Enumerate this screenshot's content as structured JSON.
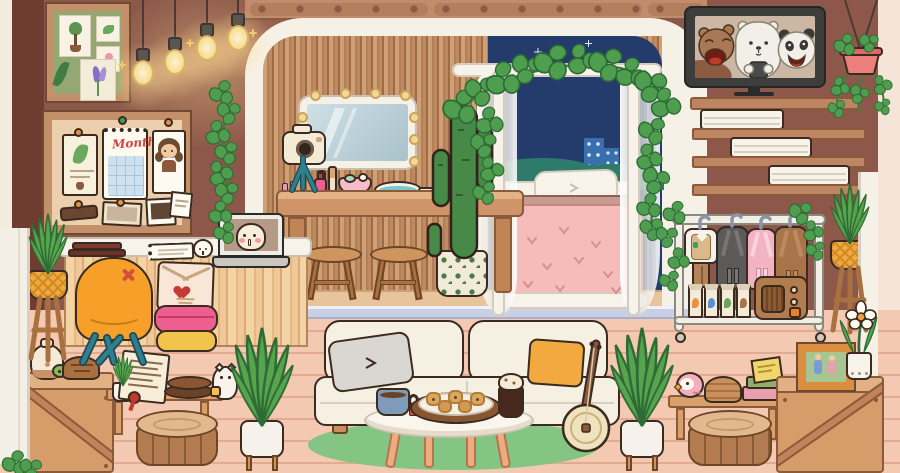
{
  "scene": {
    "name": "cozy-cartoon-room",
    "style": "toca-life-cartoon",
    "canvas": {
      "width": 900,
      "height": 473
    },
    "time_of_day_window": "night"
  },
  "texts": {
    "calendar_month": "Month"
  },
  "palette": {
    "wall": "#8d584a",
    "beam_wood": "#c18c6b",
    "arch_white": "#f6f1e7",
    "stripe_wallpaper": "#c1895f",
    "night_sky": "#233c6b",
    "floor": "#f4c9b2",
    "alcove_floor": "#e7c49c",
    "step": "#c9cfe4",
    "rug": "#84c584",
    "chair_orange": "#f6a029",
    "chair_legs_teal": "#2f7f8e",
    "box_pink": "#ee5f90",
    "box_yellow": "#f3c44d",
    "blanket_pink": "#f6bcba",
    "leaf_green": "#4f9e50",
    "crate_wood": "#d69c6a",
    "tv_frame": "#3d3d3b",
    "radio_brown": "#b27c4e",
    "hanging_pot_pink": "#ea7f7c",
    "basket_pot_yellow": "#eeaa3f"
  },
  "counts": {
    "hanging_bulbs": 4,
    "mirror_bulbs": 9,
    "stools": 2,
    "cookies": 5,
    "drink_cartons": 4,
    "hanging_outfits": 4,
    "white_book_stacks": 3,
    "wall_shelves": 3,
    "wood_stumps": 2,
    "wood_crates": 2,
    "snake_plants": 2,
    "basket_plant_stands": 2,
    "window_stars": 3
  },
  "tv": {
    "show_characters": [
      "grizzly-bear",
      "ice-bear",
      "panda-bear"
    ],
    "frame_color": "#3d3d3b"
  },
  "inventory": {
    "left_wall": [
      "botanical-frame",
      "hanging-edison-bulbs",
      "bulletin-board",
      "wall-calendar",
      "portrait-photo",
      "leaf-poster",
      "polaroid-photos",
      "white-desk",
      "laptop",
      "spiral-notebook",
      "maroon-book-stack",
      "egg-figurine",
      "orange-armchair",
      "love-letter",
      "stacked-round-boxes",
      "basket-plant-stand",
      "ivy-vine"
    ],
    "vanity_alcove": [
      "lighted-vanity-mirror",
      "camera-on-tripod",
      "lipsticks",
      "nail-polish",
      "makeup-dish",
      "hand-mirror",
      "vanity-table",
      "wooden-stools",
      "potted-cactus",
      "ivy-garland"
    ],
    "bed_nook": [
      "canopy-bed",
      "white-pillow",
      "pink-blanket",
      "sheer-curtains",
      "night-window",
      "city-skyline"
    ],
    "right_wall": [
      "flatscreen-tv",
      "tv-shelf",
      "staggered-shelves",
      "white-books",
      "rolling-clothing-rack",
      "hanging-outfits",
      "drink-cartons",
      "vintage-radio",
      "basket-plant-stand",
      "hanging-plant",
      "photo-frame",
      "white-flower-pot"
    ],
    "living_area": [
      "cream-sofa",
      "grey-pillow",
      "yellow-pillow",
      "banjo",
      "round-coffee-table",
      "tea-mug",
      "cookie-platter",
      "frappe-drink",
      "green-rug",
      "snake-plant-left",
      "snake-plant-right",
      "wood-stump-left",
      "wood-stump-right",
      "wood-crate-left",
      "wood-crate-right",
      "low-bench-left",
      "low-bench-right",
      "oil-diffuser",
      "turtle-figurine",
      "certificate-scroll",
      "wood-trays",
      "lucky-cat-figurine",
      "pink-bird",
      "wicker-basket",
      "stacked-books"
    ]
  }
}
